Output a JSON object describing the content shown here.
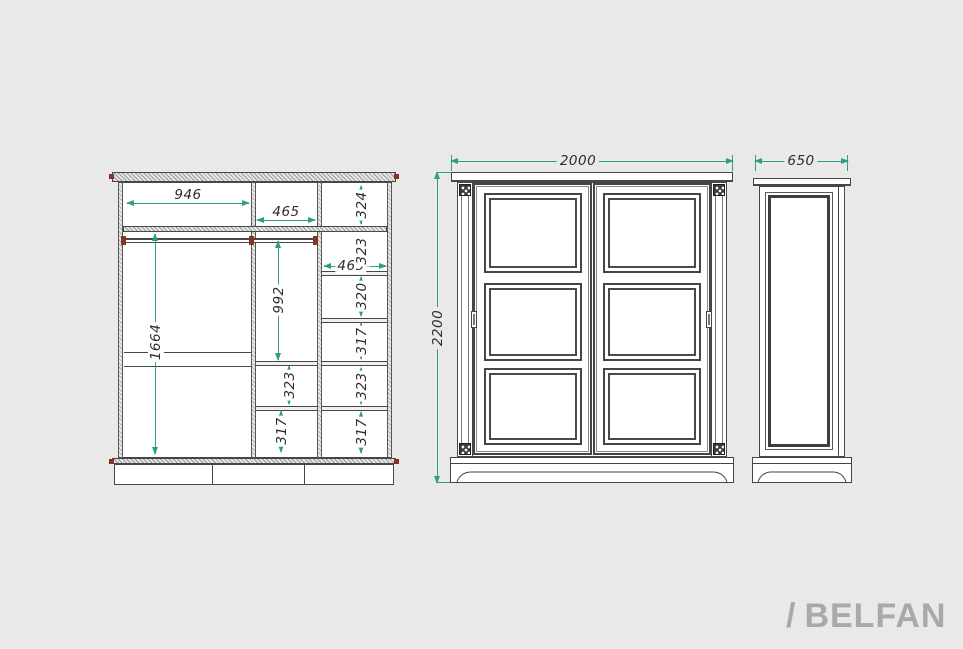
{
  "internal_view": {
    "top_width": "946",
    "mid_top_width": "465",
    "right_col_width": "465",
    "left_col_height": "1664",
    "mid_col_height": "992",
    "mid_cells": [
      "323",
      "317"
    ],
    "right_cells": [
      "324",
      "323",
      "320",
      "317",
      "323",
      "317"
    ]
  },
  "front_view": {
    "width": "2000",
    "height": "2200"
  },
  "side_view": {
    "width": "650"
  },
  "logo": {
    "slash": "/",
    "name": "BELFAN"
  },
  "colors": {
    "background": "#e9e9e9",
    "line": "#474747",
    "dimension": "#2e9e88",
    "accent_red": "#8a3222",
    "logo_gray": "#a9a9a9"
  }
}
